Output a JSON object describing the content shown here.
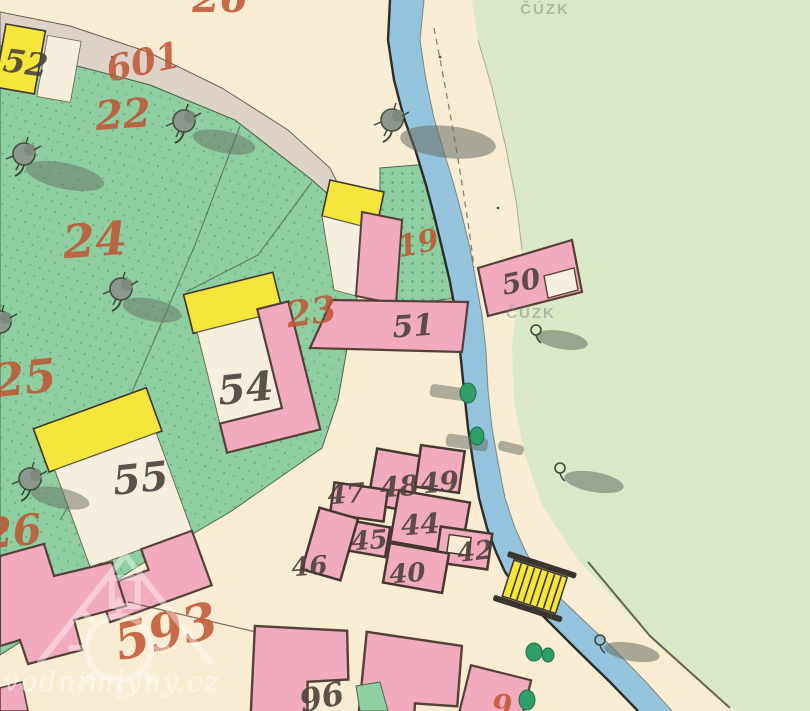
{
  "app": {
    "title": "Historic cadastral map scan (stable cadastre style)"
  },
  "colors": {
    "cream": "#f8ecd2",
    "paper": "#f6efdd",
    "meadow": "#d9e9c5",
    "garden": "#8fcea1",
    "gardenDot": "#3f8f5e",
    "river": "#94c4dd",
    "bank": "#2e2b26",
    "pink": "#f2abbe",
    "pinkStroke": "#554138",
    "yellow": "#f6e53a",
    "band": "#dcd2c6",
    "ink": "#4c423c",
    "red": "#c05431",
    "shadow": "#666e62",
    "bush": "#2f9e68"
  },
  "labels": [
    {
      "text": "26",
      "x": 220,
      "y": 12,
      "size": 40,
      "rot": 0,
      "cls": "lbl-red",
      "name": "parcel-number-top-partial"
    },
    {
      "text": "601",
      "x": 146,
      "y": 74,
      "size": 36,
      "rot": -12,
      "cls": "lbl-red",
      "name": "parcel-number-601"
    },
    {
      "text": "22",
      "x": 124,
      "y": 128,
      "size": 40,
      "rot": -4,
      "cls": "lbl-red",
      "name": "parcel-number-22"
    },
    {
      "text": "24",
      "x": 96,
      "y": 256,
      "size": 46,
      "rot": -4,
      "cls": "lbl-red",
      "name": "parcel-number-24"
    },
    {
      "text": "25",
      "x": 26,
      "y": 394,
      "size": 46,
      "rot": -6,
      "cls": "lbl-red",
      "name": "parcel-number-25"
    },
    {
      "text": "26",
      "x": 14,
      "y": 546,
      "size": 42,
      "rot": -6,
      "cls": "lbl-red",
      "name": "parcel-number-26"
    },
    {
      "text": "23",
      "x": 313,
      "y": 324,
      "size": 36,
      "rot": -8,
      "cls": "lbl-red",
      "name": "parcel-number-23"
    },
    {
      "text": "19",
      "x": 420,
      "y": 253,
      "size": 30,
      "rot": -12,
      "cls": "lbl-red",
      "name": "parcel-number-19"
    },
    {
      "text": "593",
      "x": 170,
      "y": 648,
      "size": 50,
      "rot": -14,
      "cls": "lbl-red",
      "name": "parcel-number-593"
    },
    {
      "text": "9",
      "x": 502,
      "y": 716,
      "size": 30,
      "rot": 0,
      "cls": "lbl-red",
      "name": "parcel-number-bottom-partial"
    },
    {
      "text": "52",
      "x": 24,
      "y": 74,
      "size": 32,
      "rot": 8,
      "cls": "lbl-ink",
      "name": "house-number-52"
    },
    {
      "text": "54",
      "x": 247,
      "y": 402,
      "size": 40,
      "rot": -6,
      "cls": "lbl-ink",
      "name": "house-number-54"
    },
    {
      "text": "55",
      "x": 142,
      "y": 492,
      "size": 40,
      "rot": -6,
      "cls": "lbl-ink",
      "name": "house-number-55"
    },
    {
      "text": "51",
      "x": 414,
      "y": 336,
      "size": 30,
      "rot": -4,
      "cls": "lbl-ink",
      "name": "house-number-51"
    },
    {
      "text": "50",
      "x": 523,
      "y": 291,
      "size": 28,
      "rot": -12,
      "cls": "lbl-ink",
      "name": "house-number-50"
    },
    {
      "text": "47",
      "x": 347,
      "y": 503,
      "size": 27,
      "rot": -4,
      "cls": "lbl-ink",
      "name": "house-number-47"
    },
    {
      "text": "48",
      "x": 400,
      "y": 496,
      "size": 28,
      "rot": -4,
      "cls": "lbl-ink",
      "name": "house-number-48"
    },
    {
      "text": "49",
      "x": 440,
      "y": 492,
      "size": 28,
      "rot": -4,
      "cls": "lbl-ink",
      "name": "house-number-49"
    },
    {
      "text": "45",
      "x": 370,
      "y": 549,
      "size": 26,
      "rot": -4,
      "cls": "lbl-ink",
      "name": "house-number-45"
    },
    {
      "text": "44",
      "x": 421,
      "y": 534,
      "size": 28,
      "rot": -4,
      "cls": "lbl-ink",
      "name": "house-number-44"
    },
    {
      "text": "46",
      "x": 310,
      "y": 575,
      "size": 26,
      "rot": -4,
      "cls": "lbl-ink",
      "name": "house-number-46"
    },
    {
      "text": "40",
      "x": 408,
      "y": 582,
      "size": 26,
      "rot": -4,
      "cls": "lbl-ink",
      "name": "house-number-40"
    },
    {
      "text": "42",
      "x": 476,
      "y": 560,
      "size": 26,
      "rot": -6,
      "cls": "lbl-ink",
      "name": "house-number-42"
    },
    {
      "text": "96",
      "x": 324,
      "y": 708,
      "size": 32,
      "rot": -12,
      "cls": "lbl-ink",
      "name": "house-number-96"
    }
  ],
  "watermarks": [
    {
      "text": "ČÚZK",
      "x": 545,
      "y": 14,
      "size": 15,
      "cls": "wm-gray",
      "name": "cuzk-watermark-top"
    },
    {
      "text": "ČÚZK",
      "x": 531,
      "y": 318,
      "size": 15,
      "cls": "wm-gray",
      "name": "cuzk-watermark-middle"
    },
    {
      "text": "vodnimlyny.cz",
      "x": 112,
      "y": 691,
      "size": 27,
      "cls": "wm-white",
      "name": "site-watermark"
    }
  ]
}
